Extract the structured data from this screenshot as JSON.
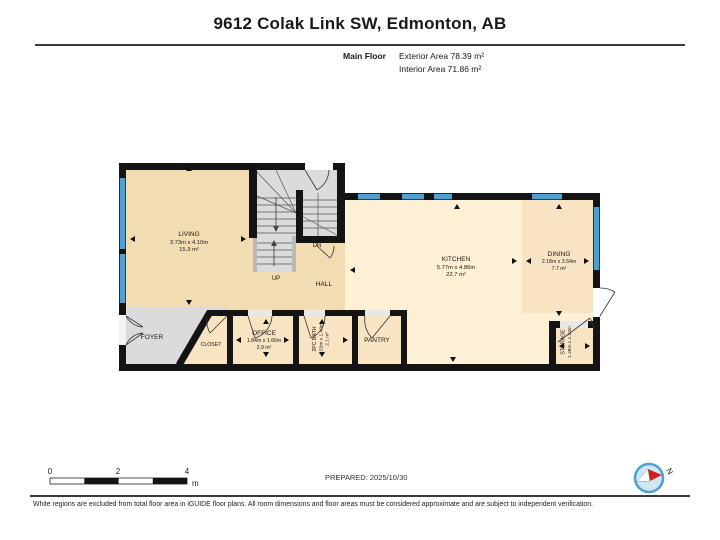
{
  "header": {
    "title": "9612 Colak Link SW, Edmonton, AB",
    "floor_label": "Main Floor",
    "exterior_area": "Exterior Area 78.39 m²",
    "interior_area": "Interior Area 71.86 m²"
  },
  "rooms": {
    "living": {
      "name": "LIVING",
      "dims": "3.73m x 4.10m",
      "area": "15.3 m²"
    },
    "kitchen": {
      "name": "KITCHEN",
      "dims": "5.77m x 4.86m",
      "area": "22.7 m²"
    },
    "dining": {
      "name": "DINING",
      "dims": "2.18m x 3.54m",
      "area": "7.7 m²"
    },
    "office": {
      "name": "OFFICE",
      "dims": "1.84m x 1.66m",
      "area": "2.9 m²"
    },
    "bath": {
      "name": "2PC BATH",
      "dims": "1.53m x 1.40m",
      "area": "2.1 m²"
    },
    "storage": {
      "name": "STORAGE",
      "dims": "1.28m x 1.23m"
    },
    "pantry": {
      "name": "PANTRY"
    },
    "foyer": {
      "name": "FOYER"
    },
    "closet": {
      "name": "CLOSET"
    },
    "hall": {
      "name": "HALL"
    },
    "up_label": "UP",
    "dn_label": "DN"
  },
  "scale_bar": {
    "ticks": [
      "0",
      "2",
      "4"
    ],
    "unit": "m"
  },
  "compass": {
    "north": "N"
  },
  "footer": {
    "prepared": "PREPARED: 2025/10/30",
    "disclaimer": "White regions are excluded from total floor area in iGUIDE floor plans. All room dimensions and floor areas must be considered approximate and are subject to independent verification."
  },
  "colors": {
    "wall": "#141414",
    "window": "#4f9fd2",
    "floor_tan": "#f2dcb2",
    "floor_kitchen": "#fdf0d5",
    "floor_room": "#f8e4c2",
    "floor_gray": "#dbdbdb"
  }
}
